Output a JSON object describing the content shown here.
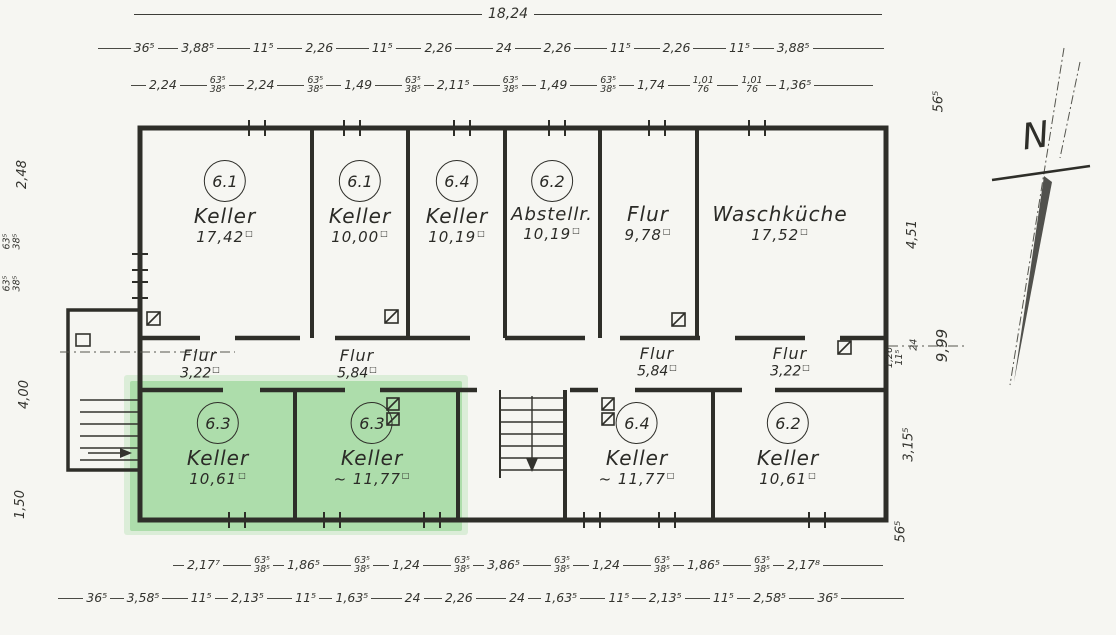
{
  "compass": {
    "label": "N"
  },
  "rooms": {
    "area_unit": "□",
    "top": [
      {
        "number": "6.1",
        "name": "Keller",
        "area": "17,42"
      },
      {
        "number": "6.1",
        "name": "Keller",
        "area": "10,00"
      },
      {
        "number": "6.4",
        "name": "Keller",
        "area": "10,19"
      },
      {
        "number": "6.2",
        "name": "Abstellr.",
        "area": "10,19"
      },
      {
        "number": "",
        "name": "Flur",
        "area": "9,78"
      },
      {
        "number": "",
        "name": "Waschküche",
        "area": "17,52"
      }
    ],
    "corridors": [
      {
        "name": "Flur",
        "area": "3,22"
      },
      {
        "name": "Flur",
        "area": "5,84"
      },
      {
        "name": "Flur",
        "area": "5,84"
      },
      {
        "name": "Flur",
        "area": "3,22"
      }
    ],
    "bottom": [
      {
        "number": "6.3",
        "name": "Keller",
        "area": "10,61",
        "highlighted": true
      },
      {
        "number": "6.3",
        "name": "Keller",
        "area": "~ 11,77",
        "highlighted": true
      },
      {
        "number": "6.4",
        "name": "Keller",
        "area": "~ 11,77",
        "highlighted": false
      },
      {
        "number": "6.2",
        "name": "Keller",
        "area": "10,61",
        "highlighted": false
      }
    ]
  },
  "dimensions": {
    "top_total": "18,24",
    "top_row_2": [
      "36⁵",
      "3,88⁵",
      "11⁵",
      "2,26",
      "11⁵",
      "2,26",
      "24",
      "2,26",
      "11⁵",
      "2,26",
      "11⁵",
      "3,88⁵"
    ],
    "top_row_3": [
      "2,24",
      "63⁵\n38⁵",
      "2,24",
      "63⁵\n38⁵",
      "1,49",
      "63⁵\n38⁵",
      "2,11⁵",
      "63⁵\n38⁵",
      "1,49",
      "63⁵\n38⁵",
      "1,74",
      "1,01\n76",
      "1,01\n76",
      "1,36⁵"
    ],
    "bottom_row_1": [
      "2,17⁷",
      "63⁵\n38⁵",
      "1,86⁵",
      "63⁵\n38⁵",
      "1,24",
      "63⁵\n38⁵",
      "3,86⁵",
      "63⁵\n38⁵",
      "1,24",
      "63⁵\n38⁵",
      "1,86⁵",
      "63⁵\n38⁵",
      "2,17⁸"
    ],
    "bottom_row_2": [
      "36⁵",
      "3,58⁵",
      "11⁵",
      "2,13⁵",
      "11⁵",
      "1,63⁵",
      "24",
      "2,26",
      "24",
      "1,63⁵",
      "11⁵",
      "2,13⁵",
      "11⁵",
      "2,58⁵",
      "36⁵"
    ],
    "left": {
      "d1": "2,48",
      "d2": "63⁵\n38⁵",
      "d3": "63⁵\n38⁵",
      "d4": "4,00",
      "d5": "1,50"
    },
    "right": {
      "d1": "56⁵",
      "d2": "4,51",
      "d3": "1,26\n11⁵",
      "d4": "24",
      "d5": "9,99",
      "d6": "3,15⁵",
      "d7": "56⁵"
    },
    "highlight_color": "#7ccb7c",
    "ink_color": "#2e2e29"
  }
}
